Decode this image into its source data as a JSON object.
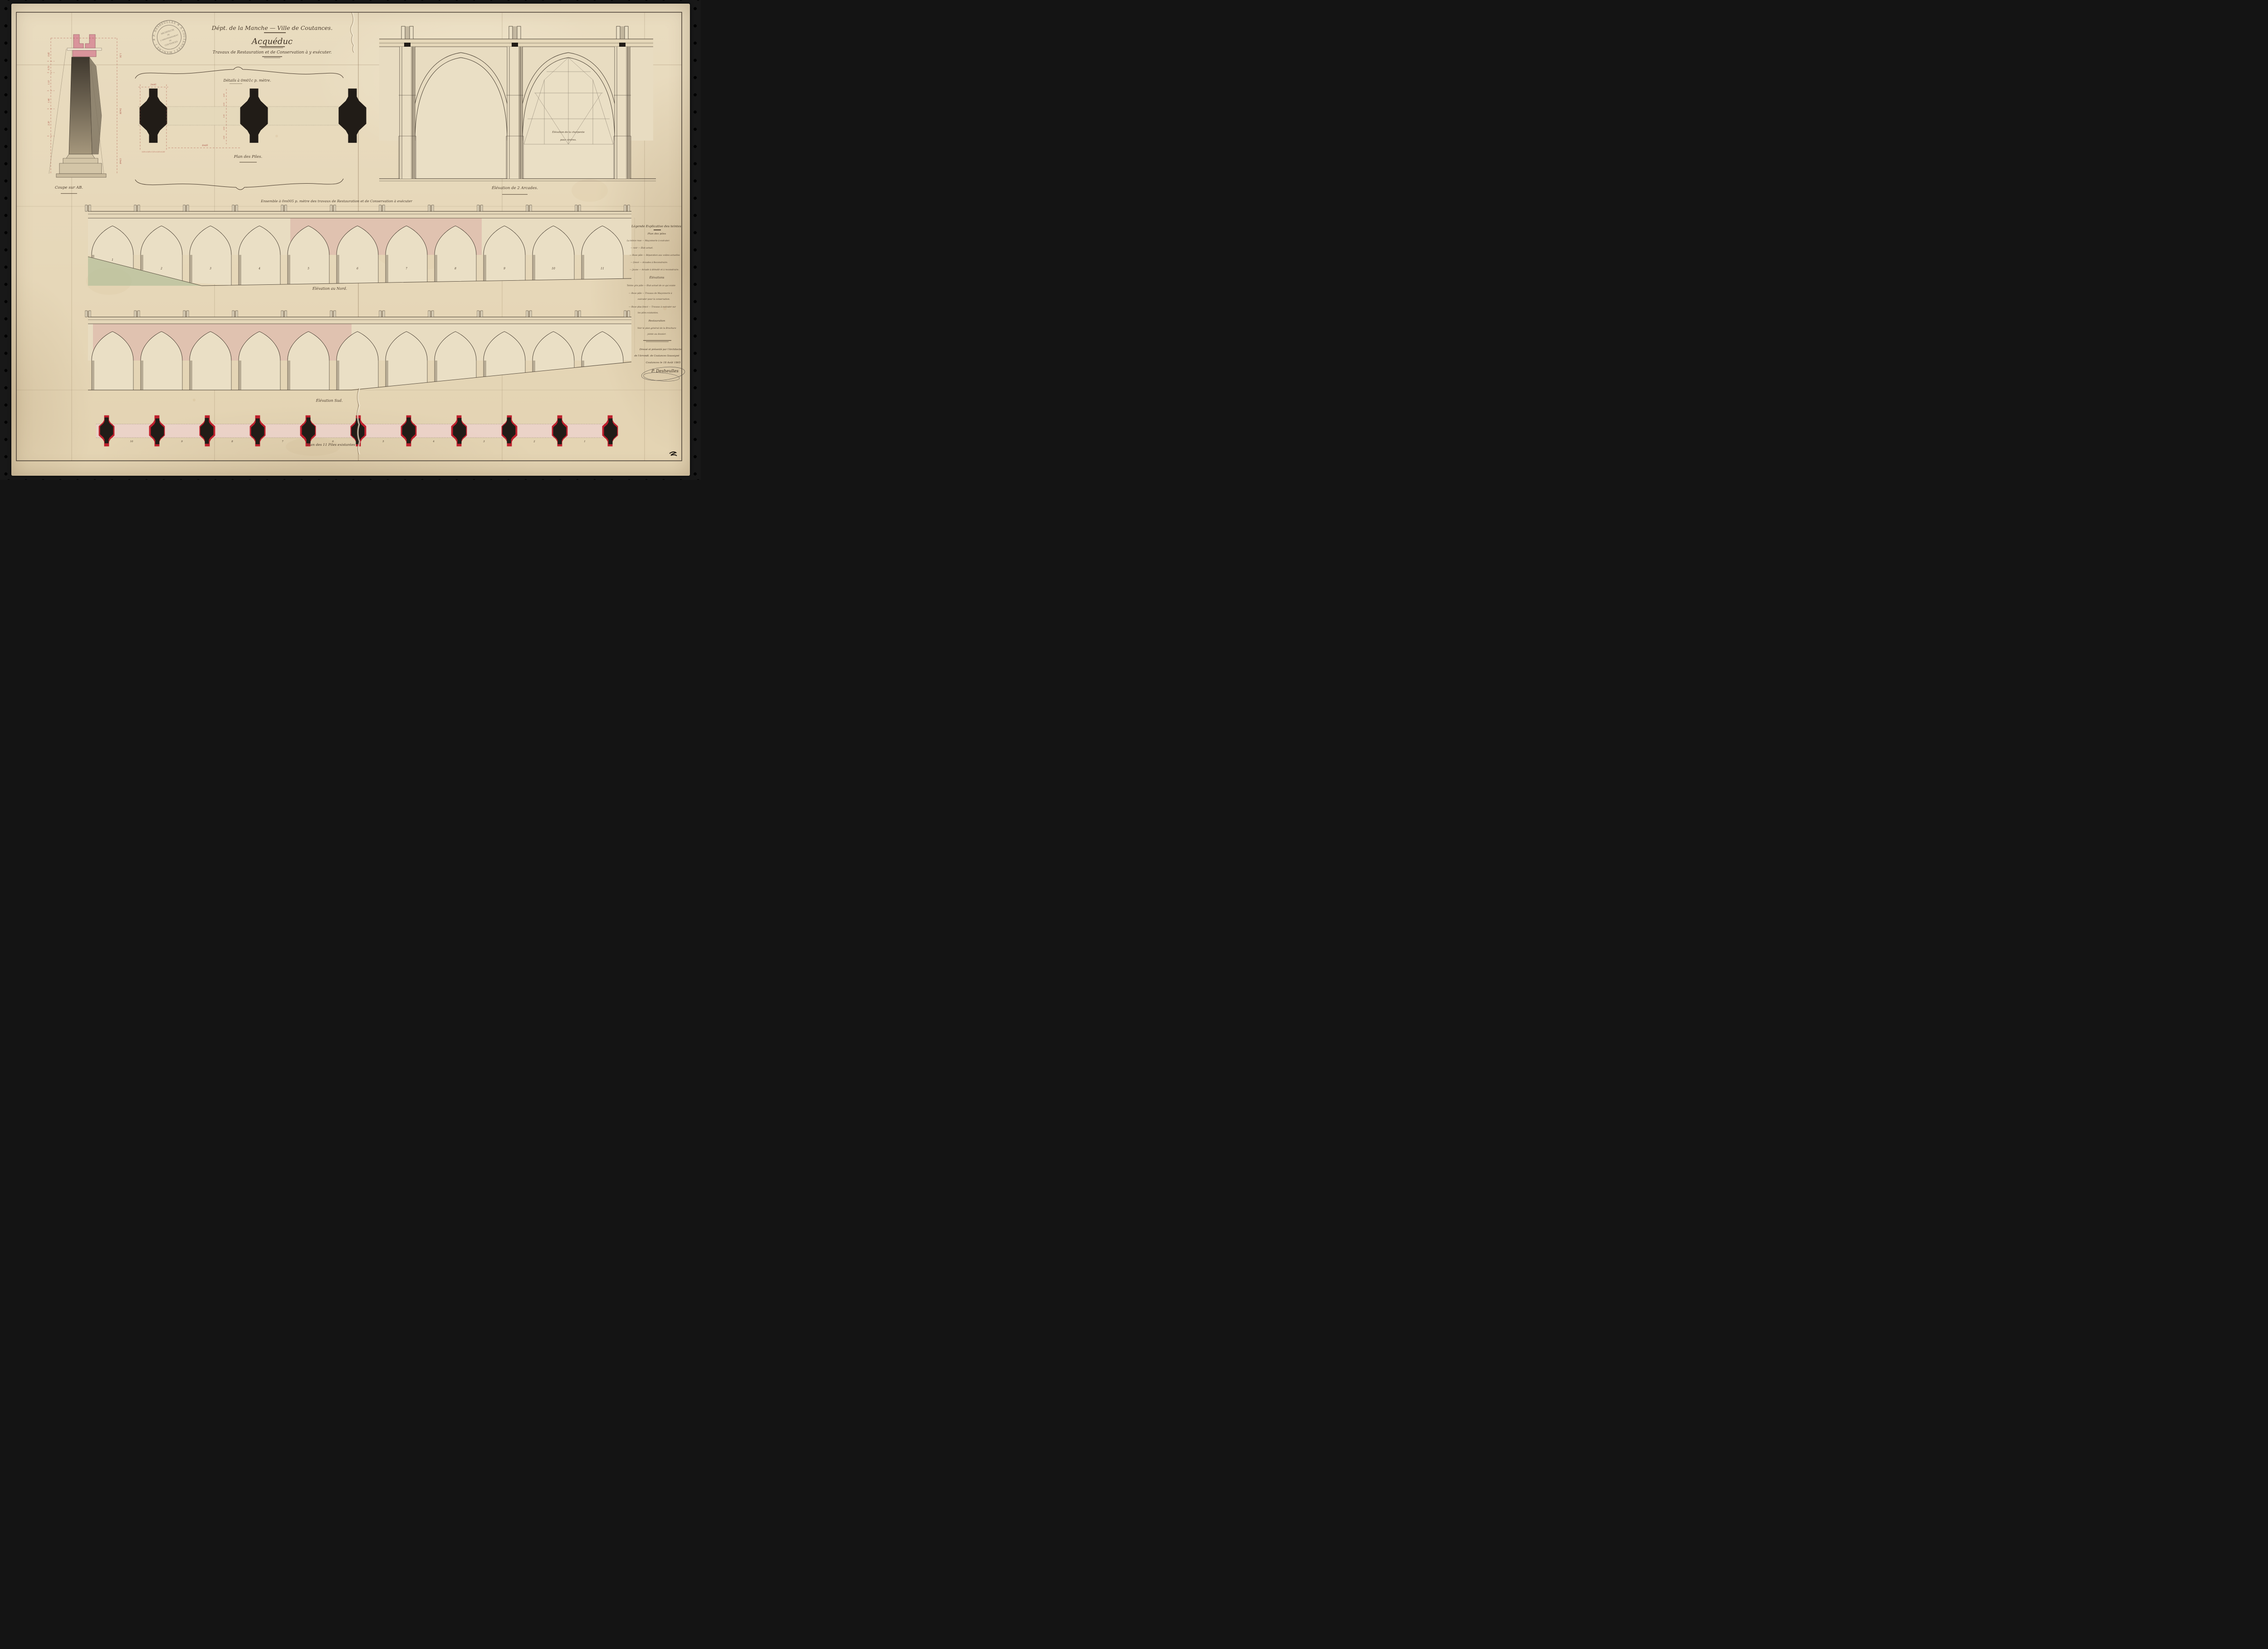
{
  "stamp": {
    "ring_text": "✳ P. DESHEULLES ✳ A COUTANCES ( MANCHE )",
    "center_lines": [
      "ARCHITECTE",
      "DE",
      "L'ARRONDISSEMENT",
      "DE",
      "COUTANCES"
    ]
  },
  "title": {
    "dept_line": "Dépt. de la Manche — Ville de Coutances.",
    "main": "Acquéduc",
    "subtitle": "Travaux de Restauration et de Conservation à y exécuter."
  },
  "labels": {
    "details": "Détails à 0m01c p. mètre.",
    "plan_piles": "Plan des Piles.",
    "coupe": "Coupe sur AB.",
    "arcades": "Élévation de 2 Arcades.",
    "charpente_1": "Élévation de la charpente",
    "charpente_2": "pour cintres.",
    "ensemble": "Ensemble à 0m005 p. mètre des travaux de Restauration et de Conservation à exécuter",
    "nord": "Élévation au Nord.",
    "sud": "Élévation Sud.",
    "plan_existantes": "Plan des 11 Piles existantes"
  },
  "legend": {
    "title": "Légende Explicative des teintes.",
    "section1": "Plan des piles",
    "rows1": [
      "La teinte rose — Maçonnerie à exécuter.",
      "—  noir  —  État actuel.",
      "— Rose pâle — Réparation aux voûtes actuelles",
      "— foncé — Arcades à Reconstruire.",
      "— Jaune — Arcade à démolir et à reconstruire."
    ],
    "section2": "Élévations",
    "rows2": [
      "Teinte gris pâle — État actuel de ce qui existe",
      "— Rose pâle — Travaux de Maçonnerie à",
      "exécuter pour la conservation.",
      "— Rose plus foncé — Travaux à exécuter sur",
      "les piles existantes."
    ],
    "footer": [
      "Restauration",
      "Voir le plan général de la Brochure",
      "jointe au dossier."
    ]
  },
  "signature": {
    "line1": "Dressé et présenté par l'Architecte",
    "line2": "de l'Arrondt. de Coutances Soussigné",
    "line3": "Coutances le 18 Août 1865",
    "name": "P. Desheulles"
  },
  "dims": {
    "plan_top_width": "3m45",
    "plan_spacing": "6m85",
    "plan_bottom": "0,50 x 0,65 x 1,15 x 0,50 x 0,50",
    "plan_side": [
      "0.85",
      "0.93",
      "1.95",
      "0.93",
      "0.85"
    ],
    "coupe_left": [
      "0.85",
      "0.70",
      "1.10",
      "1.48",
      "2.30"
    ],
    "coupe_right": [
      "1.56",
      "5m38",
      "13m8"
    ]
  },
  "numbers": {
    "nord": [
      "1",
      "2",
      "3",
      "4",
      "5",
      "6",
      "7",
      "8",
      "9",
      "10",
      "11"
    ],
    "plan": [
      "10",
      "9",
      "8",
      "7",
      "6",
      "5",
      "4",
      "3",
      "2",
      "1"
    ]
  },
  "colors": {
    "ink": "#41372c",
    "black_ink": "#211c17",
    "rose": "#d9949b",
    "rose_wash": "#d8a89f",
    "red": "#bf202d",
    "red_dim": "#a8493f",
    "gray_wash": "#857a66",
    "green_wash": "#b4bf9a",
    "wall": "#e8dcc1",
    "paper": "#eadfc5",
    "band": "#e5d7b9"
  }
}
